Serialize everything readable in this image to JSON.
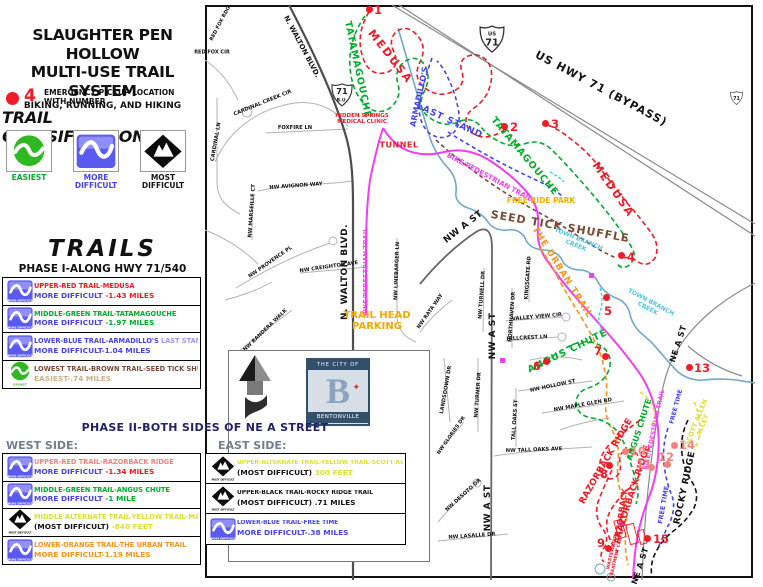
{
  "colors": {
    "red": "#ee1c25",
    "green": "#00ad2b",
    "blue": "#4545e8",
    "lightblue": "#9a9af5",
    "brown": "#7b4a32",
    "tan": "#c9b089",
    "magenta": "#f23ef2",
    "orange": "#f7941d",
    "yellow": "#dede36",
    "gold": "#f0b400",
    "gold2": "#f5a800",
    "creek_text": "#4fc3e8",
    "black": "#141414",
    "salmon": "#f2837b",
    "navy": "#22226a",
    "side_gray": "#70808e",
    "legend_blue": "#5a5af0",
    "legend_green": "#2fb821",
    "dot_red": "#ee1c25",
    "dot_salmon": "#f2837b"
  },
  "header": {
    "title_line1": "SLAUGHTER PEN HOLLOW",
    "title_line2": "MULTI-USE TRAIL SYSTEM",
    "subtitle": "BIKING, RUNNING, AND HIKING",
    "emergency_number": "4",
    "emergency_label": "EMERGENCY PICKUP LOCATION\nWITH NUMBER",
    "classifications_title": "TRAIL CLASSIFICATIONS"
  },
  "classifications": [
    {
      "type": "easiest",
      "label": "EASIEST",
      "label_color": "#00ad2b"
    },
    {
      "type": "more",
      "label": "MORE DIFFICULT",
      "label_color": "#4545e8"
    },
    {
      "type": "most",
      "label": "MOST DIFFICULT",
      "label_color": "#141414"
    }
  ],
  "trails_panel": {
    "title": "TRAILS",
    "phase1_title": "PHASE I-ALONG HWY 71/540",
    "phase1_rows": [
      {
        "icon": "more",
        "l1": [
          [
            "UPPER-RED TRAIL-MEDUSA",
            "red"
          ]
        ],
        "l2": [
          [
            "MORE DIFFICULT ",
            "blue"
          ],
          [
            "-1.43 MILES",
            "red"
          ]
        ]
      },
      {
        "icon": "more",
        "l1": [
          [
            "MIDDLE-GREEN TRAIL-TATAMAGOUCHE",
            "green"
          ]
        ],
        "l2": [
          [
            "MORE DIFFICULT ",
            "blue"
          ],
          [
            "-1.97 MILES",
            "green"
          ]
        ]
      },
      {
        "icon": "more",
        "l1": [
          [
            "LOWER-BLUE TRAIL-ARMADILLO'S ",
            "blue"
          ],
          [
            "LAST STAND",
            "lightblue"
          ]
        ],
        "l2": [
          [
            "MORE DIFFICULT-1.04 MILES",
            "blue"
          ]
        ]
      },
      {
        "icon": "easiest",
        "l1": [
          [
            "LOWEST TRAIL-BROWN TRAIL-SEED TICK SHUFFLE",
            "brown"
          ]
        ],
        "l2": [
          [
            "EASIEST-.74 MILES",
            "tan"
          ]
        ]
      }
    ]
  },
  "phase2": {
    "title": "PHASE II-BOTH SIDES OF NE A STREET",
    "west_label": "WEST SIDE:",
    "east_label": "EAST SIDE:",
    "west_rows": [
      {
        "icon": "more",
        "l1": [
          [
            "UPPER-RED TRAIL-RAZORBACK RIDGE",
            "salmon"
          ]
        ],
        "l2": [
          [
            "MORE DIFFICULT ",
            "blue"
          ],
          [
            "-1.34 MILES",
            "red"
          ]
        ]
      },
      {
        "icon": "more",
        "l1": [
          [
            "MIDDLE-GREEN TRAIL-ANGUS CHUTE",
            "green"
          ]
        ],
        "l2": [
          [
            "MORE DIFFICULT ",
            "blue"
          ],
          [
            "-1 MILE",
            "green"
          ]
        ]
      },
      {
        "icon": "most",
        "l1": [
          [
            "MIDDLE ALTERNATE TRAIL-YELLOW TRAIL-MASTER PLAN",
            "yellow"
          ]
        ],
        "l2": [
          [
            "(MOST DIFFICULT) ",
            "black"
          ],
          [
            "-840 FEET",
            "yellow"
          ]
        ]
      },
      {
        "icon": "more",
        "l1": [
          [
            "LOWER-ORANGE TRAIL-THE URBAN TRAIL",
            "orange"
          ]
        ],
        "l2": [
          [
            "MORE DIFFICULT-1.19 MILES",
            "orange"
          ]
        ]
      }
    ],
    "east_rows": [
      {
        "icon": "most",
        "l1": [
          [
            "UPPER-ALTERNATE TRAIL-YELLOW TRAIL-SCOTT ALLEN ALLEY",
            "yellow"
          ]
        ],
        "l2": [
          [
            "(MOST DIFFICULT) ",
            "black"
          ],
          [
            "300 FEET",
            "yellow"
          ]
        ]
      },
      {
        "icon": "most",
        "l1": [
          [
            "UPPER-BLACK TRAIL-ROCKY RIDGE TRAIL",
            "black"
          ]
        ],
        "l2": [
          [
            "(MOST DIFFICULT) .71 MILES",
            "black"
          ]
        ]
      },
      {
        "icon": "more",
        "l1": [
          [
            "LOWER-BLUE TRAIL-FREE TIME",
            "blue"
          ]
        ],
        "l2": [
          [
            "MORE DIFFICULT-.38 MILES",
            "blue"
          ]
        ]
      }
    ]
  },
  "logo": {
    "top": "THE CITY OF",
    "letter": "B",
    "bottom": "BENTONVILLE"
  },
  "map": {
    "shields": [
      {
        "x": 479,
        "y": 25,
        "w": 26,
        "lines": [
          "US",
          "71"
        ]
      },
      {
        "x": 331,
        "y": 83,
        "w": 22,
        "lines": [
          "71",
          "B.U."
        ]
      },
      {
        "x": 730,
        "y": 90,
        "w": 13,
        "lines": [
          "71"
        ]
      }
    ],
    "labels": [
      [
        "MEDUSA",
        390,
        57,
        52,
        "red",
        11,
        2
      ],
      [
        "TATAMAGOUCHE",
        357,
        70,
        78,
        "green",
        9.5,
        1
      ],
      [
        "MEDUSA",
        613,
        190,
        55,
        "red",
        11,
        2
      ],
      [
        "TATAMAGOUCHE",
        524,
        157,
        50,
        "green",
        9.5,
        1
      ],
      [
        "ARMADILLO'S",
        420,
        97,
        -78,
        "blue",
        8,
        0
      ],
      [
        "LAST STAND",
        449,
        122,
        25,
        "blue",
        9,
        1
      ],
      [
        "TUNNEL",
        399,
        146,
        0,
        "red",
        8,
        0.5
      ],
      [
        "HIDDEN SPRINGS\nMEDICAL CLINIC",
        362,
        119,
        0,
        "red",
        5.5,
        0
      ],
      [
        "BIKE/PEDESTRIAN TRAIL",
        489,
        178,
        28,
        "magenta",
        7,
        0
      ],
      [
        "BIKE/PEDESTRIAN TRAIL",
        366,
        272,
        -90,
        "magenta",
        6.5,
        0
      ],
      [
        "BIKE/PEDESTRIAN TRAIL",
        655,
        430,
        -78,
        "magenta",
        6,
        0
      ],
      [
        "FREE RIDE PARK",
        541,
        201,
        0,
        "gold",
        7.5,
        0
      ],
      [
        "SEED TICK SHUFFLE",
        560,
        227,
        10,
        "brown",
        11,
        1
      ],
      [
        "TOWN BRANCH\nCREEK",
        577,
        243,
        22,
        "creek_text",
        6,
        0
      ],
      [
        "TOWN BRANCH\nCREEK",
        649,
        306,
        28,
        "creek_text",
        6,
        0
      ],
      [
        "THE URBAN TRAIL",
        561,
        273,
        58,
        "orange",
        9,
        1
      ],
      [
        "ANGUS CHUTE",
        568,
        352,
        -26,
        "green",
        9.5,
        1
      ],
      [
        "ANGUS CHUTE",
        640,
        430,
        -72,
        "green",
        8,
        0
      ],
      [
        "RAZORBACK RIDGE",
        607,
        462,
        -60,
        "red",
        9,
        0
      ],
      [
        "RAZORBACK RIDGE",
        634,
        492,
        -72,
        "red",
        9,
        0
      ],
      [
        "RAZORBACK",
        622,
        516,
        -82,
        "red",
        8,
        0
      ],
      [
        "ROCKY RIDGE",
        686,
        488,
        -78,
        "black",
        9,
        0.5
      ],
      [
        "FREE TIME",
        664,
        505,
        -80,
        "blue",
        6.5,
        0
      ],
      [
        "FREE TIME",
        677,
        407,
        -75,
        "blue",
        6,
        0
      ],
      [
        "SCOTT ALLEN\nALLEY",
        700,
        424,
        -68,
        "yellow",
        6.5,
        0
      ],
      [
        "WASTEWATER\nTREATMENT CENTER",
        616,
        553,
        -77,
        "red",
        4.5,
        0
      ],
      [
        "US HWY 71 (BYPASS)",
        601,
        89,
        28,
        "black",
        11,
        1
      ],
      [
        "N. WALTON BLVD.",
        301,
        47,
        62,
        "black",
        7,
        0
      ],
      [
        "N. WALTON BLVD.",
        346,
        272,
        -90,
        "black",
        9,
        0.5
      ],
      [
        "NW A ST",
        464,
        228,
        -38,
        "black",
        9,
        0.5
      ],
      [
        "NW A ST",
        494,
        336,
        -90,
        "black",
        9,
        0.5
      ],
      [
        "NW A ST",
        489,
        508,
        -90,
        "black",
        9,
        0.5
      ],
      [
        "NE A ST",
        679,
        344,
        -72,
        "black",
        8,
        0.5
      ],
      [
        "NE A ST",
        641,
        566,
        -72,
        "black",
        8,
        0.5
      ],
      [
        "TRAIL HEAD\nPARKING",
        377,
        321,
        0,
        "gold2",
        10,
        0
      ],
      [
        "CARDINAL CREEK CIR",
        263,
        104,
        -22,
        "black",
        5.2,
        0
      ],
      [
        "FOXFIRE LN",
        295,
        129,
        0,
        "black",
        5.2,
        0
      ],
      [
        "CARDINAL LN",
        217,
        142,
        -80,
        "black",
        5.2,
        0
      ],
      [
        "NW AVIGNON WAY",
        296,
        187,
        -4,
        "black",
        5.2,
        0
      ],
      [
        "NW MARSEILLE CT",
        253,
        211,
        -86,
        "black",
        5.2,
        0
      ],
      [
        "NW PROVENCE PL",
        271,
        263,
        -35,
        "black",
        5.2,
        0
      ],
      [
        "NW CREIGHTON AVE",
        329,
        268,
        -8,
        "black",
        5.2,
        0
      ],
      [
        "NW BANDERA WALK",
        266,
        331,
        -44,
        "black",
        5.2,
        0
      ],
      [
        "NW LINEBARGER LN",
        398,
        271,
        -88,
        "black",
        5.2,
        0
      ],
      [
        "RED FOX RDG",
        221,
        24,
        -62,
        "black",
        5,
        0
      ],
      [
        "RED FOX CIR",
        212,
        53,
        0,
        "black",
        5,
        0
      ],
      [
        "NW RATA WAY",
        431,
        312,
        -55,
        "black",
        5.2,
        0
      ],
      [
        "NW TURNELL DR",
        483,
        295,
        -86,
        "black",
        5.2,
        0
      ],
      [
        "NORTHHAVEN DR",
        513,
        317,
        -86,
        "black",
        5.2,
        0
      ],
      [
        "KINGSGATE RD",
        529,
        278,
        -86,
        "black",
        5.2,
        0
      ],
      [
        "VALLEY VIEW CIR",
        537,
        318,
        -5,
        "black",
        5.2,
        0
      ],
      [
        "HILLCREST LN",
        527,
        339,
        -3,
        "black",
        5.2,
        0
      ],
      [
        "NW TURNER DR",
        479,
        395,
        -86,
        "black",
        5.2,
        0
      ],
      [
        "LANDSDOWN DR",
        447,
        390,
        -80,
        "black",
        5.2,
        0
      ],
      [
        "NW HOLLOW ST",
        553,
        387,
        -12,
        "black",
        5.2,
        0
      ],
      [
        "NW MAPLE GLEN RD",
        583,
        406,
        -10,
        "black",
        5.2,
        0
      ],
      [
        "TALL OAKS ST",
        516,
        420,
        -86,
        "black",
        5.2,
        0
      ],
      [
        "NW TALL OAKS AVE",
        534,
        451,
        -2,
        "black",
        5.2,
        0
      ],
      [
        "NW DESOTO DR",
        464,
        496,
        -42,
        "black",
        5.2,
        0
      ],
      [
        "NW LASALLE DR",
        472,
        537,
        -4,
        "black",
        5.2,
        0
      ],
      [
        "NW GLORIES DR",
        452,
        436,
        -55,
        "black",
        5,
        0
      ]
    ],
    "dots": [
      [
        "1",
        369,
        9,
        374,
        3,
        "dot_red"
      ],
      [
        "2",
        504,
        126,
        510,
        120,
        "dot_red"
      ],
      [
        "3",
        545,
        123,
        551,
        117,
        "dot_red"
      ],
      [
        "4",
        621,
        255,
        627,
        250,
        "dot_red"
      ],
      [
        "5",
        606,
        297,
        604,
        304,
        "dot_red"
      ],
      [
        "6",
        546,
        361,
        533,
        359,
        "dot_red"
      ],
      [
        "7",
        605,
        356,
        594,
        344,
        "dot_red"
      ],
      [
        "8",
        609,
        465,
        600,
        467,
        "dot_red"
      ],
      [
        "9",
        608,
        548,
        597,
        536,
        "dot_red"
      ],
      [
        "10",
        625,
        451,
        630,
        444,
        "dot_salmon"
      ],
      [
        "11",
        651,
        467,
        636,
        457,
        "dot_salmon"
      ],
      [
        "12",
        667,
        464,
        658,
        450,
        "dot_salmon"
      ],
      [
        "13",
        689,
        367,
        694,
        361,
        "dot_red"
      ],
      [
        "14",
        674,
        445,
        679,
        438,
        "dot_salmon"
      ],
      [
        "15",
        647,
        538,
        653,
        532,
        "dot_red"
      ]
    ]
  }
}
